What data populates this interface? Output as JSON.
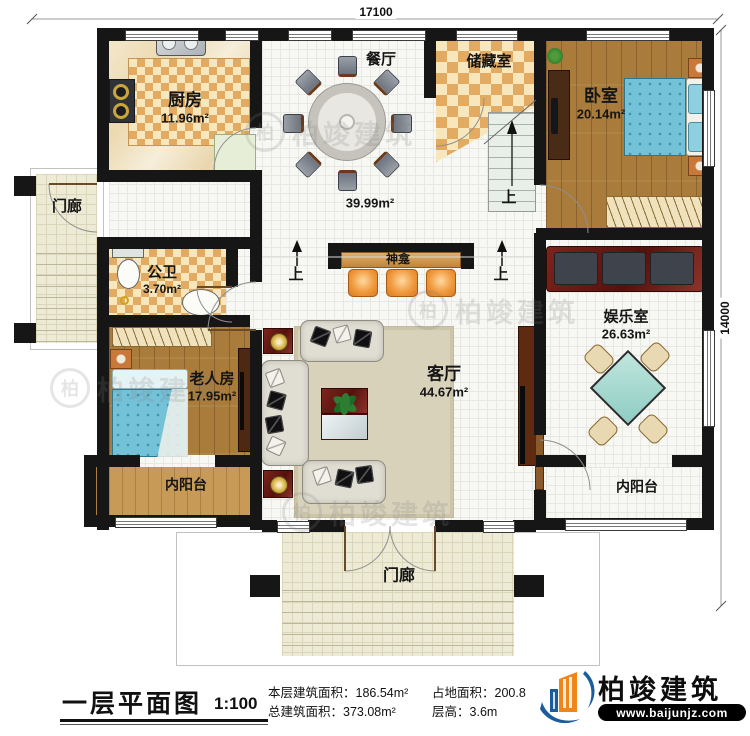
{
  "dimensions": {
    "width_top": "17100",
    "height_right": "14000"
  },
  "rooms": {
    "kitchen": {
      "name": "厨房",
      "area": "11.96m²"
    },
    "dining": {
      "name": "餐厅"
    },
    "storage": {
      "name": "储藏室"
    },
    "bedroom": {
      "name": "卧室",
      "area": "20.14m²"
    },
    "porch_left": {
      "name": "门廊"
    },
    "hall": {
      "area": "39.99m²"
    },
    "shrine": {
      "name": "神龛"
    },
    "bath": {
      "name": "公卫",
      "area": "3.70m²"
    },
    "elder_room": {
      "name": "老人房",
      "area": "17.95m²"
    },
    "living": {
      "name": "客厅",
      "area": "44.67m²"
    },
    "recreation": {
      "name": "娱乐室",
      "area": "26.63m²"
    },
    "balcony_left": {
      "name": "内阳台"
    },
    "balcony_right": {
      "name": "内阳台"
    },
    "porch_front": {
      "name": "门廊"
    }
  },
  "markers": {
    "stairs_up": "上",
    "step_up_left": "上",
    "step_up_right": "上"
  },
  "title_block": {
    "title": "一层平面图",
    "scale": "1:100",
    "floor_area_label": "本层建筑面积：",
    "floor_area_value": "186.54m²",
    "total_area_label": "总建筑面积：",
    "total_area_value": "373.08m²",
    "land_area_label": "占地面积：",
    "land_area_value": "200.8",
    "storey_height_label": "层高：",
    "storey_height_value": "3.6m"
  },
  "branding": {
    "company": "柏竣建筑",
    "website": "www.baijunjz.com",
    "watermark": "柏竣建筑",
    "watermark_badge": "柏",
    "logo_blue": "#1a5c9e",
    "logo_orange": "#f08519"
  },
  "colors": {
    "wall": "#161616",
    "wood_floor": "#a97c3c",
    "checker_tile": "#e3ab62",
    "bed_blue": "#74c2d8",
    "mahjong_table": "#a8dbd2",
    "maroon_furniture": "#6e2618"
  }
}
